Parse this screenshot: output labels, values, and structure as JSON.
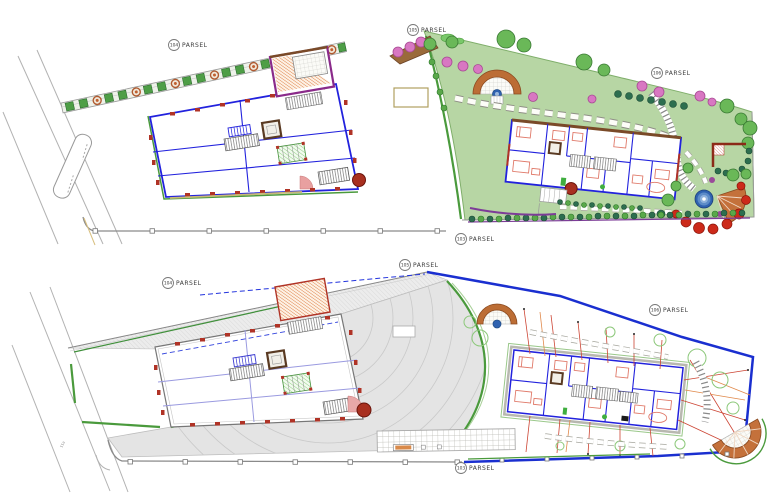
{
  "sheet": {
    "type": "architectural-site-plan",
    "panels": [
      "landscape-site-plan",
      "ground-floor-paving-plan"
    ]
  },
  "plans": {
    "top": {
      "parcel_labels": [
        {
          "number": "104",
          "word": "PARSEL"
        },
        {
          "number": "105",
          "word": "PARSEL"
        },
        {
          "number": "106",
          "word": "PARSEL"
        },
        {
          "number": "103",
          "word": "PARSEL"
        }
      ]
    },
    "bottom": {
      "parcel_labels": [
        {
          "number": "104",
          "word": "PARSEL"
        },
        {
          "number": "105",
          "word": "PARSEL"
        },
        {
          "number": "106",
          "word": "PARSEL"
        },
        {
          "number": "103",
          "word": "PARSEL"
        }
      ],
      "road_label": "11a"
    }
  },
  "colors": {
    "wall_blue": "#2222dd",
    "boundary_blue": "#1a2fd0",
    "lawn_green": "#b7d6a4",
    "curb_green": "#4a9a3c",
    "terracotta": "#bc6d35",
    "column_red": "#b03326",
    "furniture_red": "#e07a6a",
    "pavement_gray": "#e2e2e2",
    "fountain_blue": "#2f62b0",
    "flower_pink": "#d877c2",
    "ramp_purple": "#8a2a8a",
    "roofline_red": "#cc4433"
  }
}
